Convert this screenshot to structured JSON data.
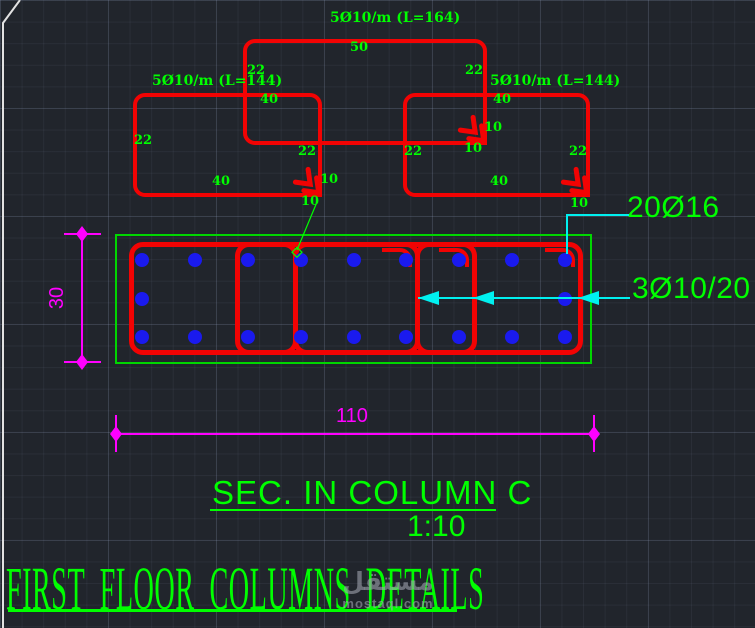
{
  "colors": {
    "background": "#21252c",
    "red": "#f20303",
    "green": "#00ff00",
    "blue": "#1a1aee",
    "cyan": "#00f0f0",
    "magenta": "#ff00ff",
    "white_edge": "#e2e2e2",
    "watermark_gray": "#9ea4ae"
  },
  "top_stirrups": {
    "rects": [
      {
        "id": "stirrup-middle",
        "x": 243,
        "y": 39,
        "w": 244,
        "h": 106
      },
      {
        "id": "stirrup-left",
        "x": 133,
        "y": 93,
        "w": 189,
        "h": 104
      },
      {
        "id": "stirrup-right",
        "x": 403,
        "y": 93,
        "w": 187,
        "h": 104
      }
    ],
    "hook_chevrons": [
      {
        "x": 483,
        "y": 140
      },
      {
        "x": 318,
        "y": 192
      },
      {
        "x": 586,
        "y": 192
      }
    ],
    "labels": [
      {
        "text": "5Ø10/m (L=164)",
        "x": 330,
        "y": 11,
        "size": "lg"
      },
      {
        "text": "50",
        "x": 350,
        "y": 41,
        "size": "sm"
      },
      {
        "text": "22",
        "x": 247,
        "y": 64,
        "size": "sm"
      },
      {
        "text": "22",
        "x": 465,
        "y": 64,
        "size": "sm"
      },
      {
        "text": "5Ø10/m (L=144)",
        "x": 152,
        "y": 74,
        "size": "lg"
      },
      {
        "text": "5Ø10/m (L=144)",
        "x": 490,
        "y": 74,
        "size": "lg"
      },
      {
        "text": "40",
        "x": 260,
        "y": 93,
        "size": "sm"
      },
      {
        "text": "40",
        "x": 493,
        "y": 93,
        "size": "sm"
      },
      {
        "text": "10",
        "x": 484,
        "y": 121,
        "size": "sm"
      },
      {
        "text": "22",
        "x": 134,
        "y": 134,
        "size": "sm"
      },
      {
        "text": "10",
        "x": 464,
        "y": 142,
        "size": "sm"
      },
      {
        "text": "22",
        "x": 298,
        "y": 145,
        "size": "sm"
      },
      {
        "text": "22",
        "x": 404,
        "y": 145,
        "size": "sm"
      },
      {
        "text": "22",
        "x": 569,
        "y": 145,
        "size": "sm"
      },
      {
        "text": "10",
        "x": 320,
        "y": 173,
        "size": "sm"
      },
      {
        "text": "40",
        "x": 212,
        "y": 175,
        "size": "sm"
      },
      {
        "text": "40",
        "x": 490,
        "y": 175,
        "size": "sm"
      },
      {
        "text": "10",
        "x": 301,
        "y": 195,
        "size": "sm"
      },
      {
        "text": "10",
        "x": 570,
        "y": 197,
        "size": "sm"
      }
    ]
  },
  "green_leader": {
    "x1": 317,
    "y1": 202,
    "x2": 297,
    "y2": 250
  },
  "section": {
    "outline": {
      "x": 115,
      "y": 234,
      "w": 477,
      "h": 130
    },
    "stirrup_top": 242,
    "stirrup_h": 113,
    "stirrups": [
      {
        "x": 129,
        "w": 169
      },
      {
        "x": 235,
        "w": 185
      },
      {
        "x": 293,
        "w": 184
      },
      {
        "x": 415,
        "w": 168
      }
    ],
    "hook_legs": [
      415,
      472,
      578
    ],
    "rebar_rows": [
      {
        "y": 260,
        "xs": [
          142,
          195,
          248,
          301,
          354,
          406,
          459,
          512,
          565
        ]
      },
      {
        "y": 299,
        "xs": [
          142,
          565
        ]
      },
      {
        "y": 337,
        "xs": [
          142,
          195,
          248,
          301,
          354,
          406,
          459,
          512,
          565
        ]
      }
    ]
  },
  "callouts": {
    "bars_label": "20Ø16",
    "bars_pos": {
      "x": 627,
      "y": 193
    },
    "bars_leader": {
      "hx1": 567,
      "hx2": 629,
      "hy": 215,
      "vx": 567,
      "vy1": 215,
      "vy2": 254
    },
    "stirrups_label": "3Ø10/20",
    "stirrups_pos": {
      "x": 632,
      "y": 274
    },
    "stirrups_leader": {
      "y": 298,
      "x1": 418,
      "x2": 630,
      "arrow_tips": [
        418,
        473,
        578
      ]
    }
  },
  "dimensions": {
    "height": {
      "value": "30",
      "line_x": 82,
      "y1": 234,
      "y2": 362,
      "tick_x1": 64,
      "tick_x2": 101,
      "text_cx": 59,
      "text_cy": 298
    },
    "width": {
      "value": "110",
      "line_y": 434,
      "x1": 116,
      "x2": 594,
      "tick_y1": 415,
      "tick_y2": 452,
      "text_x": 336,
      "text_y": 406
    }
  },
  "titles": {
    "section_title": "SEC. IN COLUMN C",
    "scale": "1:10",
    "main_title": "FIRST FLOOR COLUMNS DETAILS"
  },
  "watermark": {
    "arabic": "مستقل",
    "domain": "mostaql.com"
  },
  "viewport_edge": {
    "points": "20,0 3,23 3,628"
  }
}
